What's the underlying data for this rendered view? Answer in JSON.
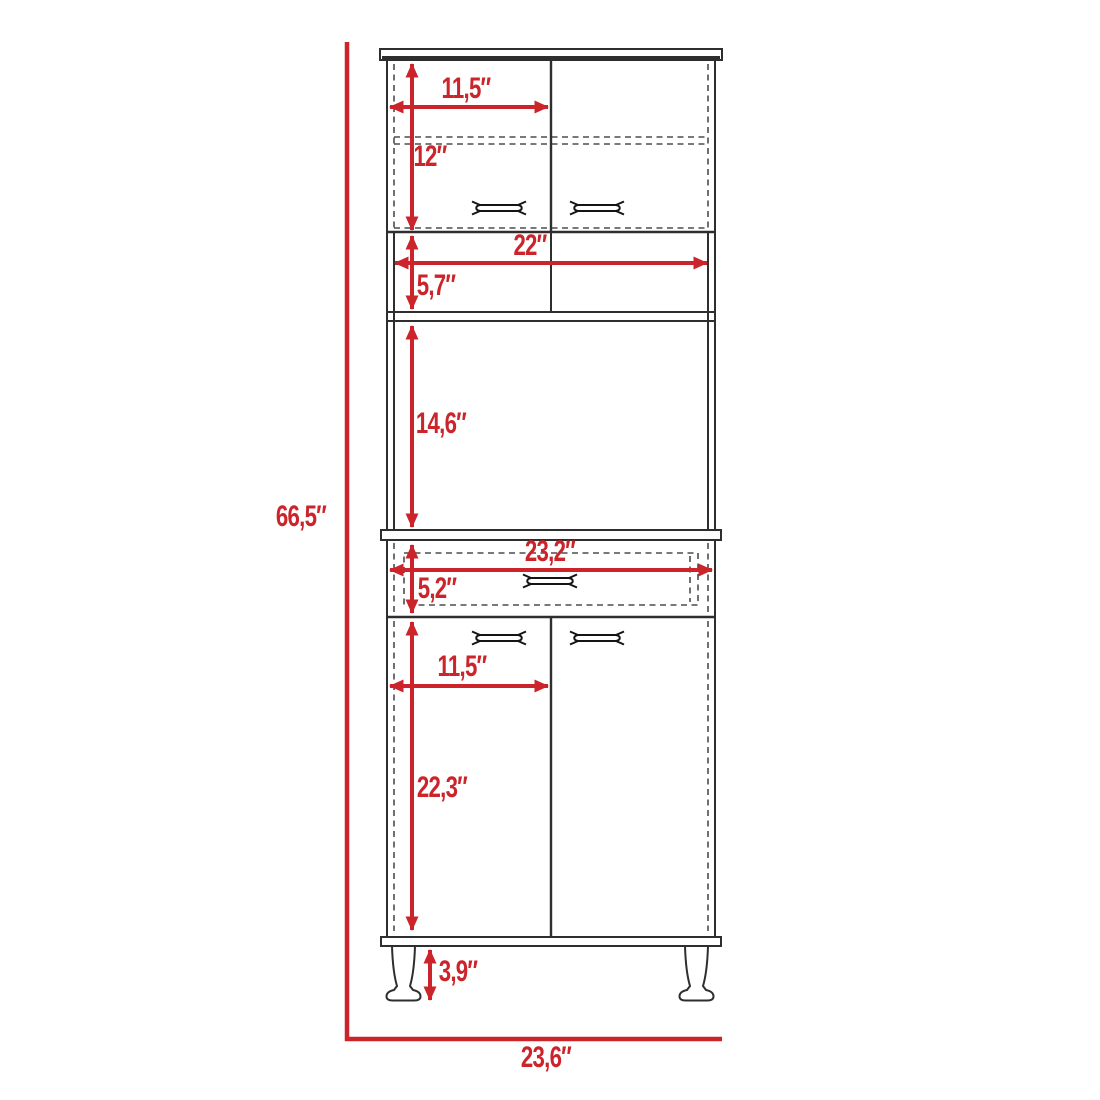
{
  "colors": {
    "dimension_red": "#cc242b",
    "line_dark": "#2e2e2e",
    "dash_gray": "#4d4d4d",
    "handle_black": "#141414",
    "background": "#ffffff"
  },
  "diagram": {
    "type": "furniture-dimension-diagram",
    "object": "tall pantry cabinet front elevation",
    "dimensions": {
      "overall_height": "66,5″",
      "overall_width": "23,6″",
      "hutch_door_width": "11,5″",
      "hutch_door_height": "12″",
      "open_shelf_width": "22″",
      "open_shelf_height": "5,7″",
      "microwave_space_height": "14,6″",
      "drawer_width": "23,2″",
      "drawer_height": "5,2″",
      "base_door_width": "11,5″",
      "base_door_height": "22,3″",
      "leg_height": "3,9″"
    }
  }
}
